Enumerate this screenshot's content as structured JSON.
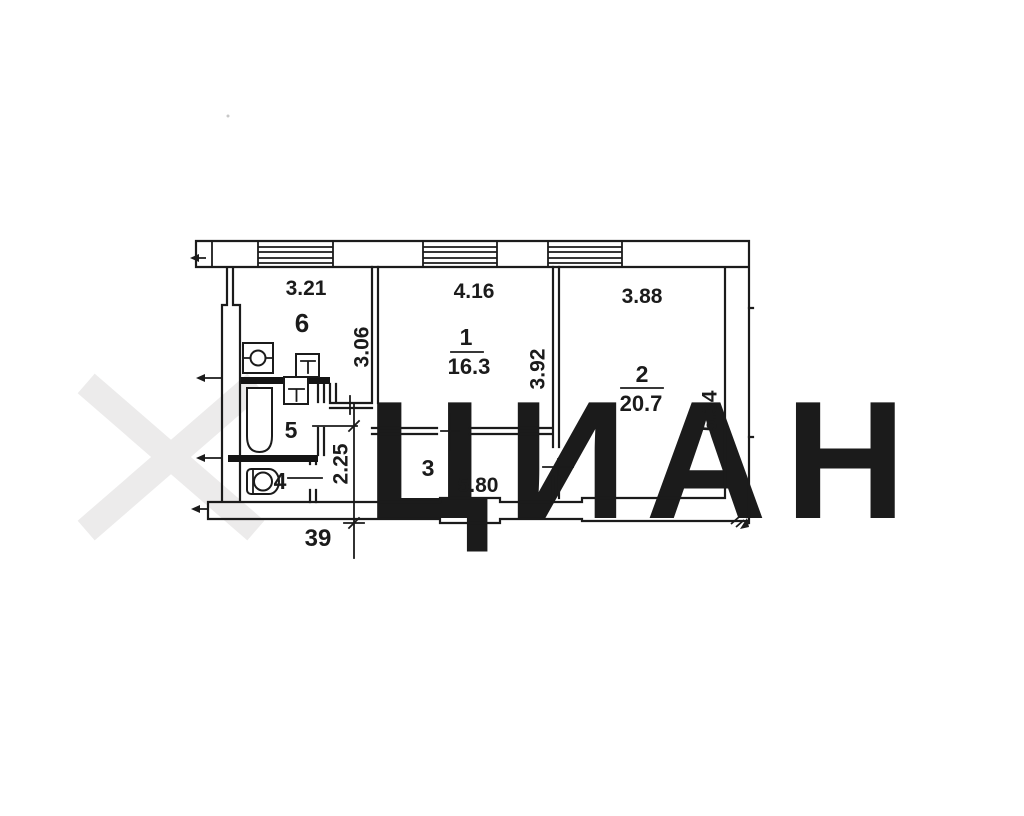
{
  "watermark": {
    "text": "ЦИАН",
    "color": "#efeeee",
    "logo": "cian-x-logo"
  },
  "plan": {
    "number": {
      "value": "39",
      "color": "#bf3f5f"
    },
    "rooms": [
      {
        "label": "6",
        "width": "3.21",
        "depth": "3.06"
      },
      {
        "label": "1",
        "area": "16.3",
        "width": "4.16",
        "depth": "3.92"
      },
      {
        "label": "2",
        "area": "20.7",
        "width": "3.88",
        "depth": "5.34"
      },
      {
        "label": "3",
        "length": "5.80",
        "width": "2.25"
      },
      {
        "label": "5"
      },
      {
        "label": "4"
      }
    ]
  },
  "colors": {
    "line": "#1b1b1b",
    "partition": "#141414",
    "dimension_red": "#bf3f5f",
    "watermark": "#efeeee"
  }
}
